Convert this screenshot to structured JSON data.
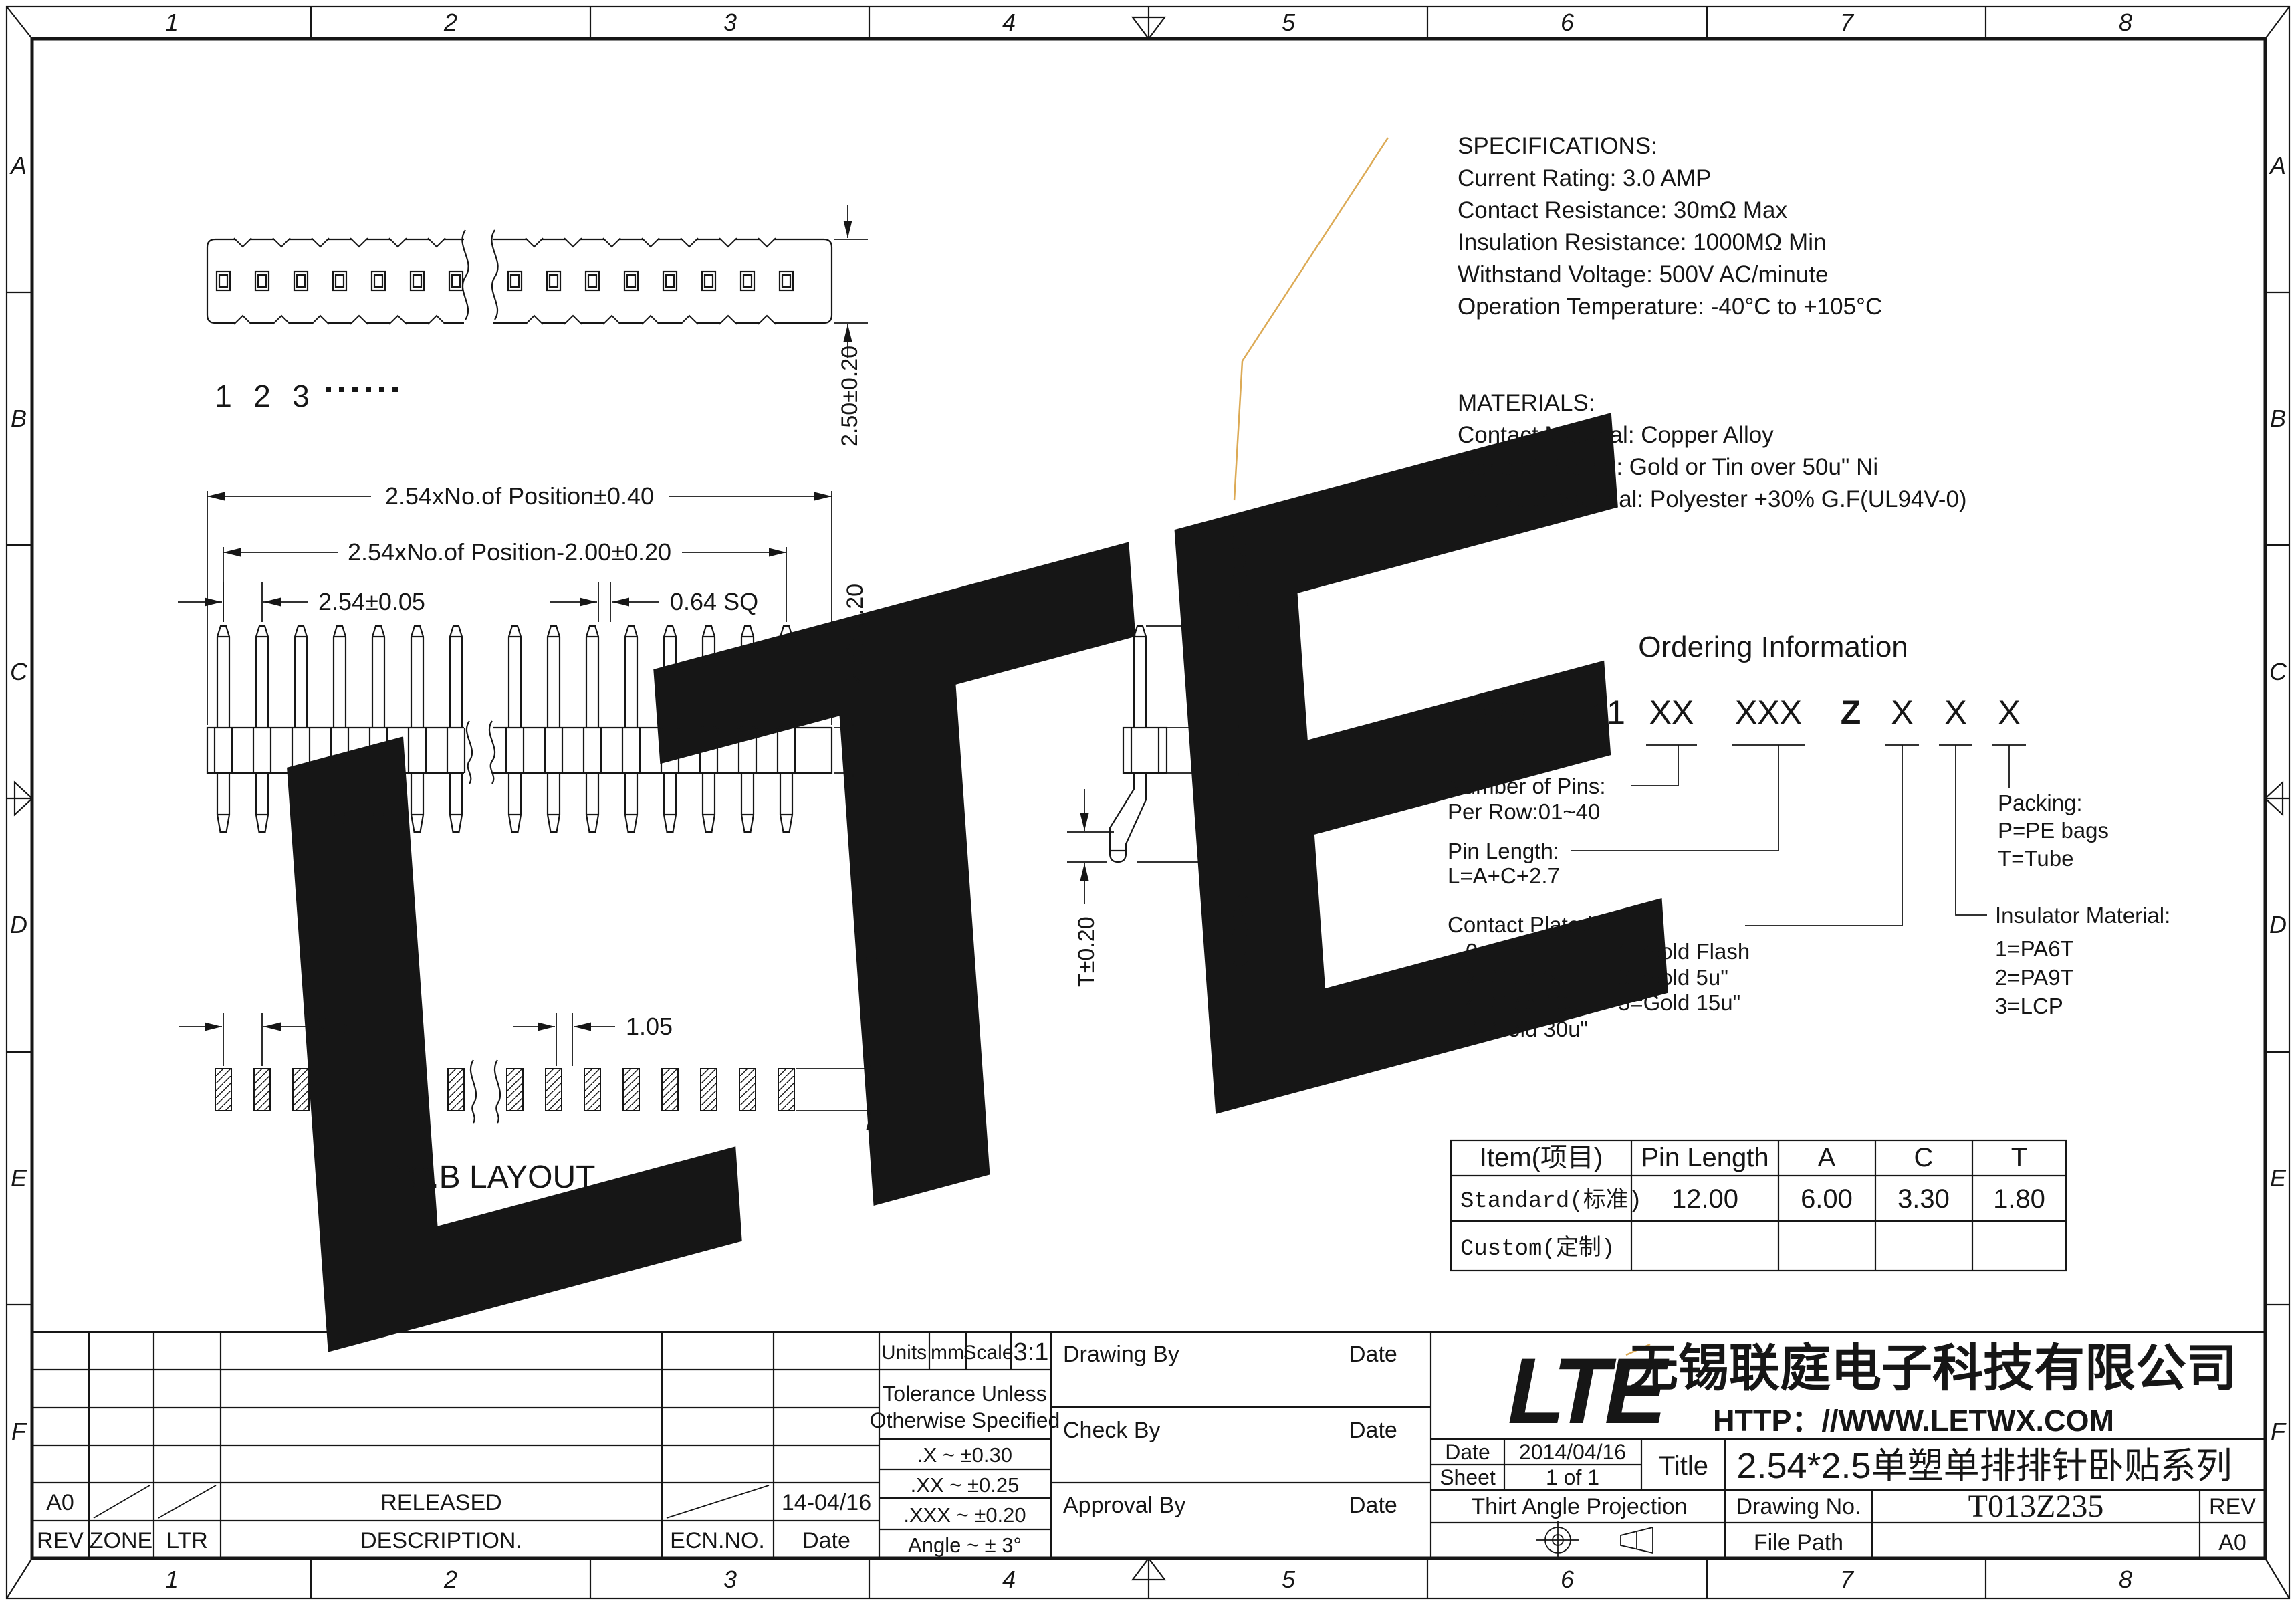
{
  "colors": {
    "line": "#161616",
    "watermark": "#e4e4e4",
    "accent_orange": "#dcaa55",
    "paper": "#ffffff"
  },
  "border": {
    "cols": [
      "1",
      "2",
      "3",
      "4",
      "5",
      "6",
      "7",
      "8"
    ],
    "rows": [
      "A",
      "B",
      "C",
      "D",
      "E",
      "F"
    ]
  },
  "views": {
    "pin_numbers": [
      "1",
      "2",
      "3"
    ],
    "pcb_label": "P.C.B LAYOUT"
  },
  "dims": {
    "strip_height": "2.50±0.20",
    "overall": "2.54xNo.of Position±0.40",
    "inner": "2.54xNo.of Position-2.00±0.20",
    "pitch": "2.54±0.05",
    "pin_sq": "0.64 SQ",
    "body_h": "2.50±0.20",
    "a": "A±0.20",
    "c": "C±0.25",
    "t": "T±0.20",
    "pcb_pitch": "2.54",
    "pcb_pad": "1.05",
    "pcb_t": "T+1.0"
  },
  "specifications": {
    "title": "SPECIFICATIONS:",
    "lines": [
      "Current Rating: 3.0 AMP",
      "Contact Resistance: 30mΩ Max",
      "Insulation Resistance: 1000MΩ Min",
      "Withstand Voltage: 500V AC/minute",
      "Operation Temperature: -40°C to +105°C"
    ]
  },
  "materials": {
    "title": "MATERIALS:",
    "lines": [
      "Contact Material: Copper Alloy",
      "Contact Plating: Gold or Tin over 50u\" Ni",
      "Insulator Material: Polyester +30% G.F(UL94V-0)"
    ]
  },
  "ordering": {
    "title": "Ordering Information",
    "part": {
      "base": "1325",
      "dash": "-",
      "series": "11",
      "pins": "XX",
      "length": "XXX",
      "z": "Z",
      "x1": "X",
      "x2": "X",
      "x3": "X"
    },
    "pins_label1": "Number of Pins:",
    "pins_label2": "Per Row:01~40",
    "length_label1": "Pin Length:",
    "length_label2": "L=A+C+2.7",
    "plating_title": "Contact  Plated:",
    "plating": [
      "0=Tin",
      "1=Gold Flash",
      "2=Gold  3u\"",
      "3=Gold  5u\"",
      "4=Gold 10u\"",
      "5=Gold 15u\"",
      "6=Gold  30u\""
    ],
    "packing_title": "Packing:",
    "packing": [
      "P=PE bags",
      "T=Tube"
    ],
    "insulator_title": "Insulator Material:",
    "insulator": [
      "1=PA6T",
      "2=PA9T",
      "3=LCP"
    ]
  },
  "table": {
    "headers": [
      "Item(项目)",
      "Pin Length",
      "A",
      "C",
      "T"
    ],
    "standard": {
      "label": "Standard(标准)",
      "pin_length": "12.00",
      "a": "6.00",
      "c": "3.30",
      "t": "1.80"
    },
    "custom": {
      "label": "Custom(定制)"
    }
  },
  "title_block": {
    "rev_row": {
      "rev": "A0",
      "description": "RELEASED",
      "date": "14-04/16"
    },
    "rev_headers": [
      "REV",
      "ZONE",
      "LTR",
      "DESCRIPTION.",
      "ECN.NO.",
      "Date"
    ],
    "units_label": "Units",
    "units_value": "mm",
    "scale_label": "Scale",
    "scale_value": "3:1",
    "tolerance_line1": "Tolerance Unless",
    "tolerance_line2": "Otherwise Specified",
    "tol_rows": [
      ".X  ~  ±0.30",
      ".XX  ~  ±0.25",
      ".XXX  ~  ±0.20",
      "Angle  ~  ± 3°"
    ],
    "sign_rows": [
      {
        "label": "Drawing By",
        "date": "Date"
      },
      {
        "label": "Check  By",
        "date": "Date"
      },
      {
        "label": "Approval By",
        "date": "Date"
      }
    ],
    "logo": "LTE",
    "company": "无锡联庭电子科技有限公司",
    "url": "HTTP：//WWW.LETWX.COM",
    "date_label": "Date",
    "date_value": "2014/04/16",
    "sheet_label": "Sheet",
    "sheet_value": "1 of 1",
    "title_label": "Title",
    "title_value": "2.54*2.5单塑单排排针卧贴系列",
    "projection": "Thirt Angle Projection",
    "drawing_no_label": "Drawing No.",
    "drawing_no": "T013Z235",
    "rev_label": "REV",
    "file_path_label": "File Path",
    "rev_value": "A0"
  }
}
